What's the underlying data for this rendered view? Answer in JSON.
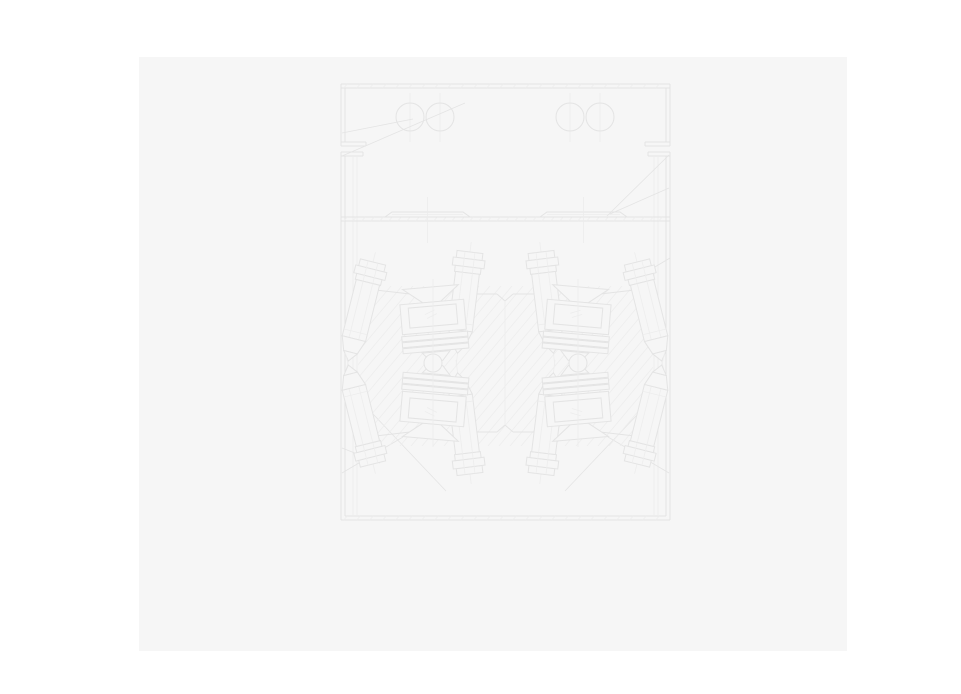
{
  "window": {
    "bg": "#ffffff"
  },
  "page": {
    "x": 139,
    "y": 57,
    "width": 708,
    "height": 594,
    "bg": "#f6f6f6"
  },
  "drawing": {
    "viewbox": [
      335,
      78,
      340,
      448
    ],
    "colors": {
      "line": "#e4e4e4",
      "light": "#ededed",
      "fill": "#f6f6f6"
    },
    "frame": {
      "left": 341,
      "right": 670,
      "top": 84,
      "bottom": 520,
      "wall": 4,
      "flange_upper_y": 142,
      "flange_lower_y": 152,
      "flange_h": 4,
      "flange_upper_len": 25,
      "flange_lower_len": 22,
      "inner_left": 353,
      "inner_right": 654,
      "inner_wall": 4,
      "inner_top": 156
    },
    "divider": {
      "y": 217,
      "t": 4,
      "tick_step": 9
    },
    "border_tick_step": 13,
    "top_circles": {
      "r": 14,
      "cy": 117,
      "cx": [
        410,
        440,
        570,
        600
      ],
      "cl_y1": 93,
      "cl_y2": 142
    },
    "rails": {
      "y_top": 212,
      "y_base": 217,
      "shoulder": 7,
      "cl_y1": 197,
      "cl_y2": 243,
      "items": [
        [
          385,
          470
        ],
        [
          540,
          627
        ]
      ]
    },
    "hatch": {
      "x1": 358,
      "x2": 653,
      "y1": 286,
      "y2": 446,
      "step": 11,
      "run": 134
    },
    "plate": {
      "mirror_sum": 726,
      "upper_edges": [
        [
          358,
          288,
          410,
          294
        ],
        [
          456,
          294,
          497,
          294
        ],
        [
          497,
          294,
          505,
          301
        ],
        [
          505,
          301,
          513,
          294
        ],
        [
          513,
          294,
          554,
          294
        ],
        [
          600,
          294,
          653,
          288
        ]
      ]
    },
    "bolts": {
      "placements": [
        [
          373,
          262,
          14
        ],
        [
          470,
          252,
          7
        ],
        [
          541,
          252,
          -7
        ],
        [
          637,
          262,
          -14
        ]
      ],
      "head": [
        [
          -13,
          0,
          26,
          7
        ],
        [
          -16,
          7,
          32,
          8
        ],
        [
          -13,
          15,
          26,
          6
        ]
      ],
      "head_lines_x": [
        -5,
        5
      ],
      "shaft": [
        -12,
        21,
        24,
        58
      ],
      "shaft_inner_x": 5,
      "collar_y": 72,
      "tip": [
        [
          -12,
          79
        ],
        [
          12,
          79
        ],
        [
          7,
          93
        ],
        [
          -7,
          93
        ]
      ],
      "point": [
        [
          -7,
          93
        ],
        [
          7,
          93
        ],
        [
          0,
          102
        ]
      ],
      "cl": [
        -10,
        115
      ],
      "mirror_sum": 726
    },
    "clusters": {
      "items": [
        [
          433,
          -5
        ],
        [
          578,
          5
        ]
      ],
      "mirror_sum": 726,
      "pivot_y_rot": 316,
      "funnel": [
        [
          -28,
          287
        ],
        [
          28,
          287
        ],
        [
          9,
          302
        ],
        [
          -9,
          302
        ]
      ],
      "block": [
        -32,
        302,
        64,
        30
      ],
      "window": [
        -24,
        306,
        48,
        20
      ],
      "window_marks": [
        [
          -8,
          314,
          2,
          310
        ],
        [
          -6,
          318,
          4,
          314
        ]
      ],
      "springs_y": [
        334,
        340,
        346
      ],
      "spring": [
        -33,
        66,
        5
      ],
      "link": [
        [
          -14,
          352
        ],
        [
          14,
          352
        ],
        [
          6,
          361
        ],
        [
          -6,
          361
        ]
      ],
      "cl": [
        279,
        447
      ]
    },
    "pivots": {
      "r": 9,
      "cy": 363,
      "cx": [
        433,
        578
      ]
    },
    "center_line": {
      "x": 505,
      "y1": 301,
      "y2": 425
    },
    "leaders": [
      [
        342,
        133,
        413,
        119
      ],
      [
        342,
        156,
        465,
        103
      ],
      [
        669,
        155,
        607,
        216
      ],
      [
        669,
        188,
        610,
        214
      ],
      [
        670,
        258,
        643,
        274
      ],
      [
        342,
        473,
        403,
        437
      ],
      [
        342,
        448,
        380,
        463
      ],
      [
        355,
        395,
        446,
        491
      ],
      [
        669,
        473,
        608,
        437
      ],
      [
        656,
        395,
        565,
        491
      ]
    ]
  }
}
